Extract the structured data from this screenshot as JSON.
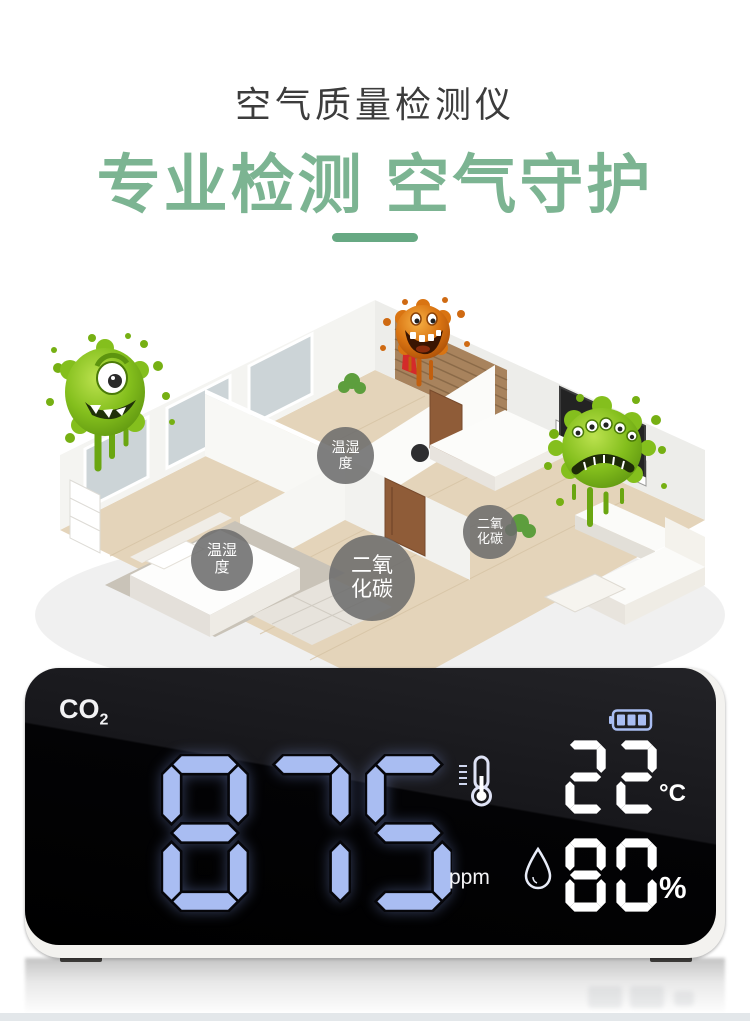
{
  "header": {
    "subtitle": "空气质量检测仪",
    "title": "专业检测 空气守护"
  },
  "scene": {
    "labels": [
      {
        "line1": "温湿",
        "line2": "度"
      },
      {
        "line1": "温湿",
        "line2": "度"
      },
      {
        "line1": "二氧",
        "line2": "化碳"
      },
      {
        "line1": "二氧",
        "line2": "化碳"
      }
    ]
  },
  "device": {
    "gas": "CO",
    "gas_sub": "2",
    "co2": {
      "value": "875",
      "unit": "ppm"
    },
    "temperature": {
      "value": "22",
      "unit": "°C"
    },
    "humidity": {
      "value": "80",
      "unit": "%"
    },
    "battery_bars": 3
  },
  "colors": {
    "accent_green": "#7cb492",
    "divider_green": "#67a983",
    "segment_blue": "#a9bdf2",
    "segment_white": "#ffffff"
  }
}
